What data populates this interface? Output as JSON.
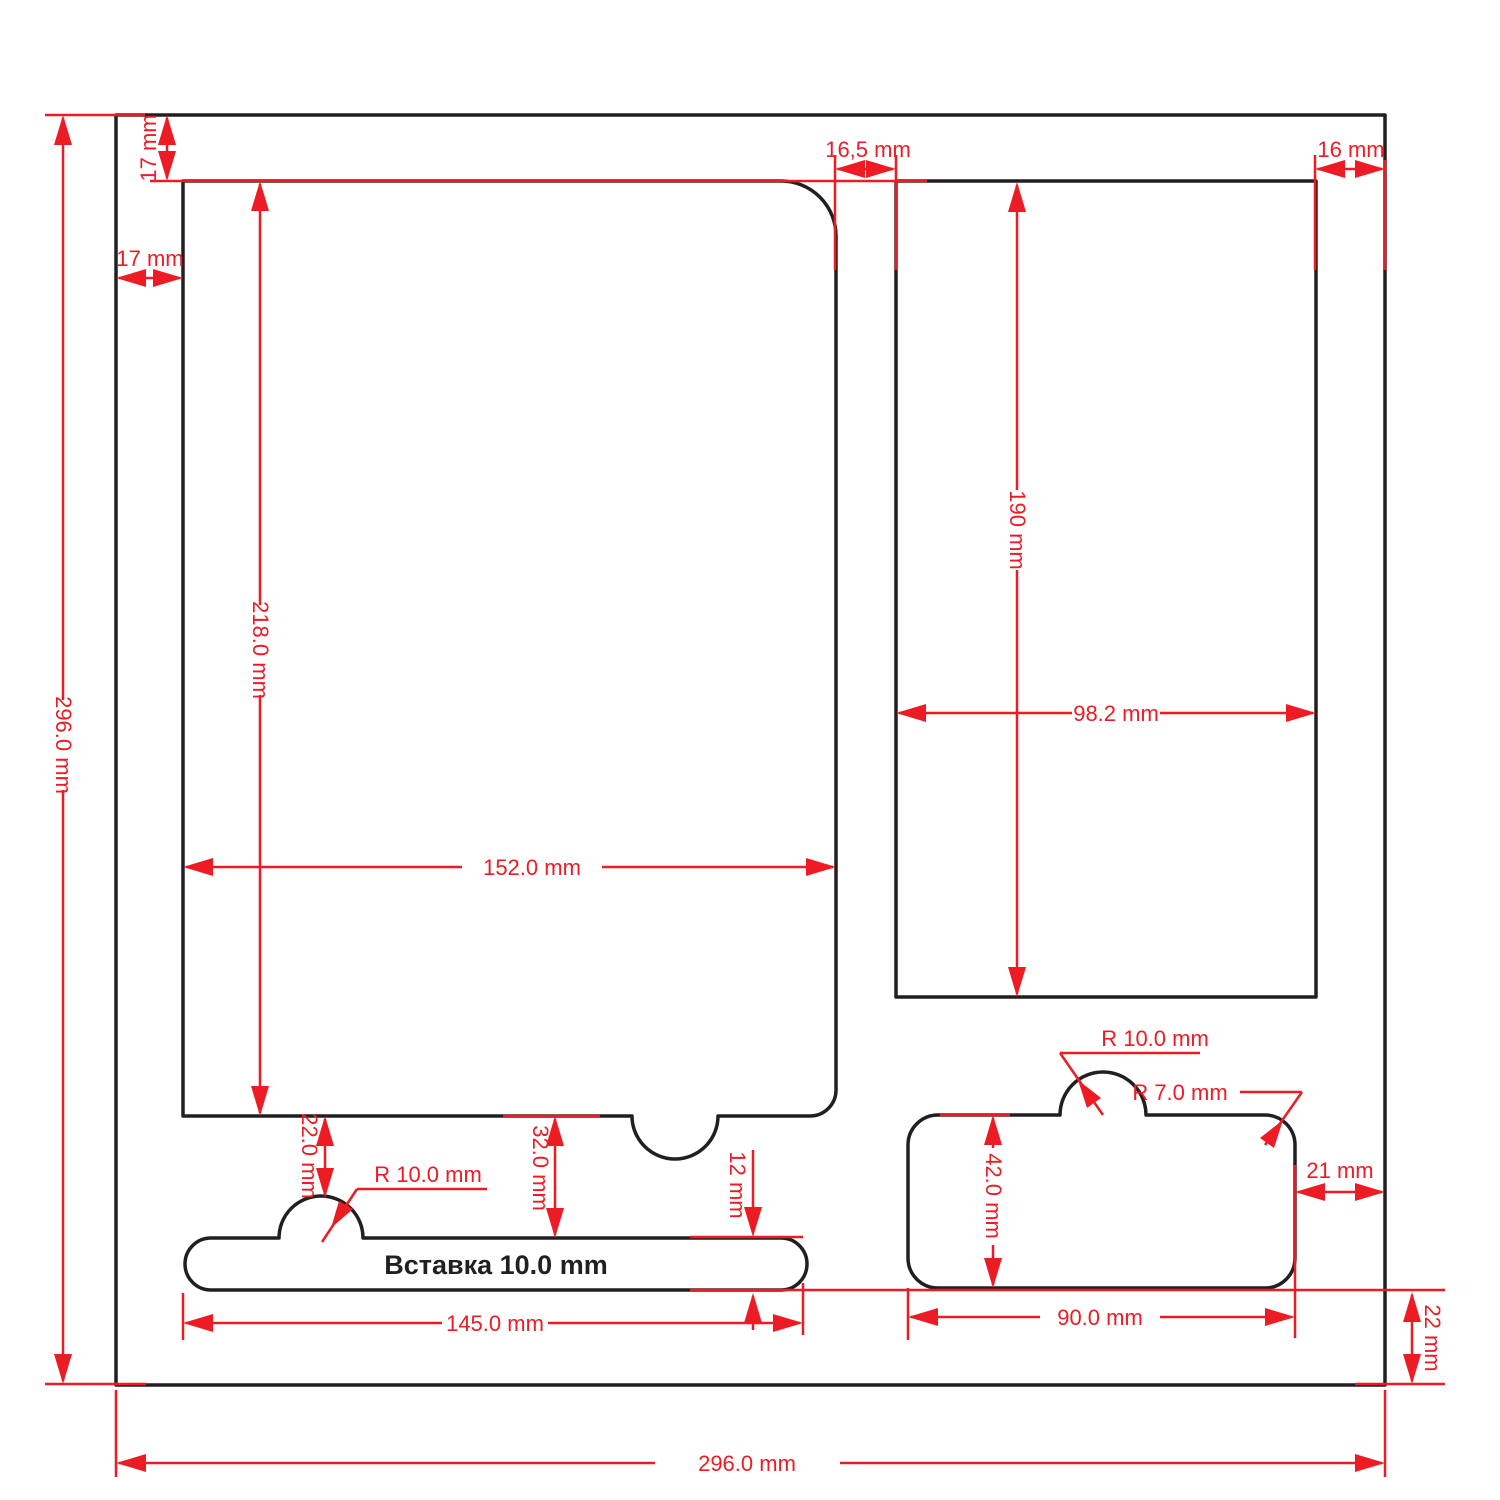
{
  "drawing": {
    "type": "foam-insert cutting layout",
    "colors": {
      "dimension_red": "#ed1c24",
      "outline_black": "#231f20",
      "background": "#ffffff"
    },
    "labels": {
      "sheet_height": "296.0 mm",
      "sheet_width": "296.0 mm",
      "top_margin": "17 mm",
      "left_margin": "17 mm",
      "tablet_right_gap": "16,5 mm",
      "right_margin": "16 mm",
      "tablet_height": "218.0 mm",
      "tablet_width": "152.0 mm",
      "pocket_height": "190 mm",
      "pocket_width": "98.2 mm",
      "notch_offset": "22.0 mm",
      "bar_bump_radius": "R 10.0 mm",
      "bar_gap": "32.0 mm",
      "bar_height": "12 mm",
      "bar_width": "145.0 mm",
      "insert_caption": "Вставка 10.0 mm",
      "box_bump_radius": "R 10.0 mm",
      "box_corner_radius": "R 7.0 mm",
      "box_height": "42.0 mm",
      "box_right_gap": "21 mm",
      "box_width": "90.0 mm",
      "box_bottom_gap": "22 mm"
    }
  }
}
